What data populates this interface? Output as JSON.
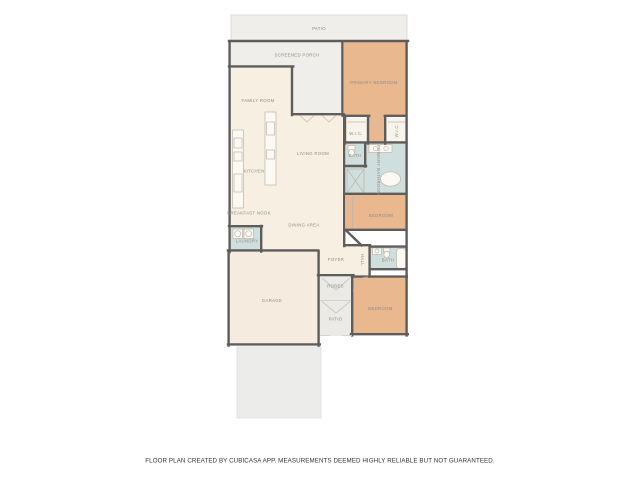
{
  "footer": {
    "disclaimer": "FLOOR PLAN CREATED BY CUBICASA APP. MEASUREMENTS DEEMED HIGHLY RELIABLE BUT NOT GUARANTEED."
  },
  "colors": {
    "wall": "#5e5d5b",
    "interior": "#f8efe3",
    "garage": "#f5ecdf",
    "closet": "#f8f4ec",
    "bedroom": "#eab88f",
    "bath": "#cfdfdd",
    "outdoor": "#efeeea",
    "outdoor_column": "#ebeae6",
    "driveway": "#ececea",
    "label": "#8e8a83"
  },
  "rooms": {
    "patio_top": {
      "label": "PATIO"
    },
    "screened_porch": {
      "label": "SCREENED PORCH"
    },
    "primary_bedroom": {
      "label": "PRIMARY BEDROOM"
    },
    "family_room": {
      "label": "FAMILY ROOM"
    },
    "living_room": {
      "label": "LIVING ROOM"
    },
    "kitchen": {
      "label": "KITCHEN"
    },
    "wic_left": {
      "label": "W.I.C."
    },
    "wic_right": {
      "label": "W.I.C."
    },
    "primary_wc": {
      "label": "BATH"
    },
    "primary_bathroom": {
      "label": "PRIMARY BATHROOM"
    },
    "breakfast_nook": {
      "label": "BREAKFAST NOOK"
    },
    "dining_area": {
      "label": "DINING AREA"
    },
    "laundry": {
      "label": "LAUNDRY"
    },
    "bedroom_middle": {
      "label": "BEDROOM"
    },
    "foyer": {
      "label": "FOYER"
    },
    "hall": {
      "label": "HALL"
    },
    "hall_bath": {
      "label": "BATH"
    },
    "garage": {
      "label": "GARAGE"
    },
    "robes": {
      "label": "ROBES"
    },
    "patio_bottom": {
      "label": "PATIO"
    },
    "bedroom_lower": {
      "label": "BEDROOM"
    }
  }
}
